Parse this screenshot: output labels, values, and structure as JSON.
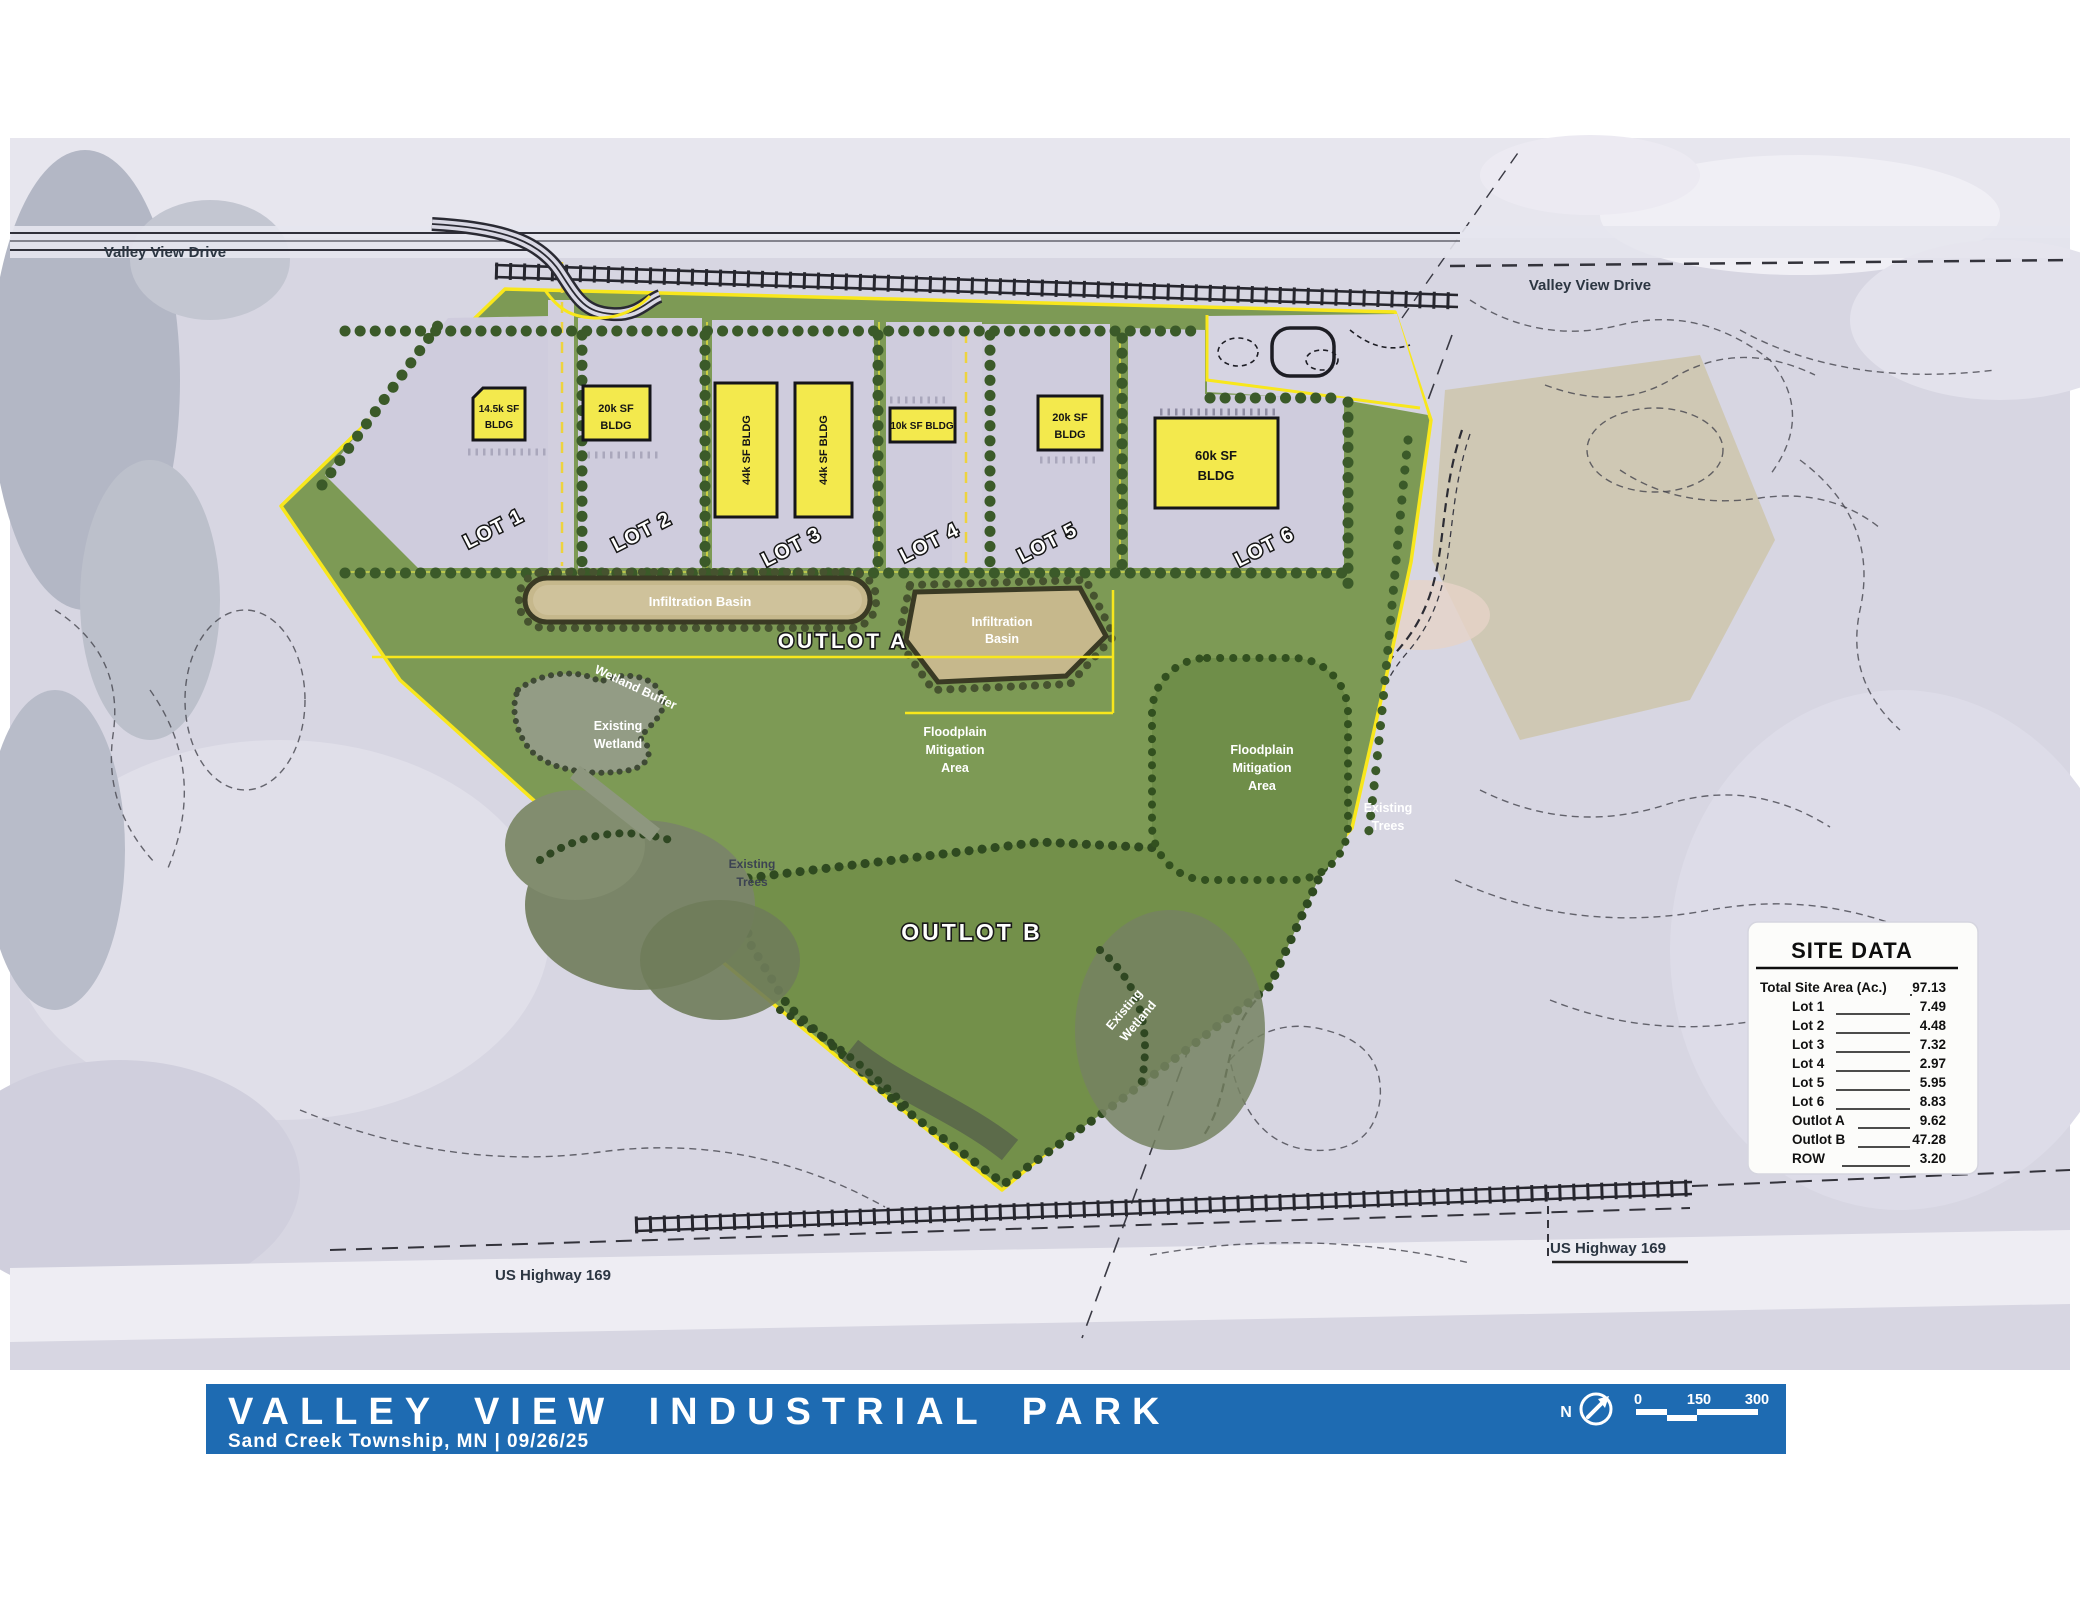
{
  "map": {
    "road_labels": {
      "valley_view_drive_left": "Valley View Drive",
      "valley_view_drive_right": "Valley View Drive",
      "us_highway_169_left": "US Highway 169",
      "us_highway_169_right": "US Highway 169"
    },
    "lots": [
      {
        "name": "LOT 1",
        "bldg_l1": "14.5k SF",
        "bldg_l2": "BLDG"
      },
      {
        "name": "LOT 2",
        "bldg_l1": "20k SF",
        "bldg_l2": "BLDG"
      },
      {
        "name": "LOT 3",
        "bldg": "44k SF BLDG"
      },
      {
        "name": "LOT 4",
        "bldg": "10k SF BLDG"
      },
      {
        "name": "LOT 5",
        "bldg_l1": "20k SF",
        "bldg_l2": "BLDG"
      },
      {
        "name": "LOT 6",
        "bldg_l1": "60k SF",
        "bldg_l2": "BLDG"
      }
    ],
    "areas": {
      "outlot_a": "OUTLOT A",
      "outlot_b": "OUTLOT B",
      "infiltration_basin": "Infiltration Basin",
      "infiltration_l1": "Infiltration",
      "infiltration_l2": "Basin",
      "wetland_buffer": "Wetland  Buffer",
      "existing_wetland_l1": "Existing",
      "existing_wetland_l2": "Wetland",
      "existing_trees_l1": "Existing",
      "existing_trees_l2": "Trees",
      "floodplain_l1": "Floodplain",
      "floodplain_l2": "Mitigation",
      "floodplain_l3": "Area"
    }
  },
  "site_data": {
    "title": "SITE DATA",
    "rows": [
      {
        "label": "Total Site Area (Ac.)",
        "value": "97.13"
      },
      {
        "label": "Lot 1",
        "value": "7.49"
      },
      {
        "label": "Lot 2",
        "value": "4.48"
      },
      {
        "label": "Lot 3",
        "value": "7.32"
      },
      {
        "label": "Lot 4",
        "value": "2.97"
      },
      {
        "label": "Lot 5",
        "value": "5.95"
      },
      {
        "label": "Lot 6",
        "value": "8.83"
      },
      {
        "label": "Outlot A",
        "value": "9.62"
      },
      {
        "label": "Outlot B",
        "value": "47.28"
      },
      {
        "label": "ROW",
        "value": "3.20"
      }
    ]
  },
  "title_block": {
    "title": "VALLEY VIEW INDUSTRIAL PARK",
    "subtitle": "Sand Creek Township, MN  |  09/26/25"
  },
  "scale_bar": {
    "north_label": "N",
    "ticks": [
      "0",
      "150",
      "300"
    ]
  },
  "colors": {
    "accent_blue": "#1e6bb2",
    "site_green": "#7d9a55",
    "building_yellow": "#f3e94d",
    "boundary_yellow": "#f8e71c"
  }
}
